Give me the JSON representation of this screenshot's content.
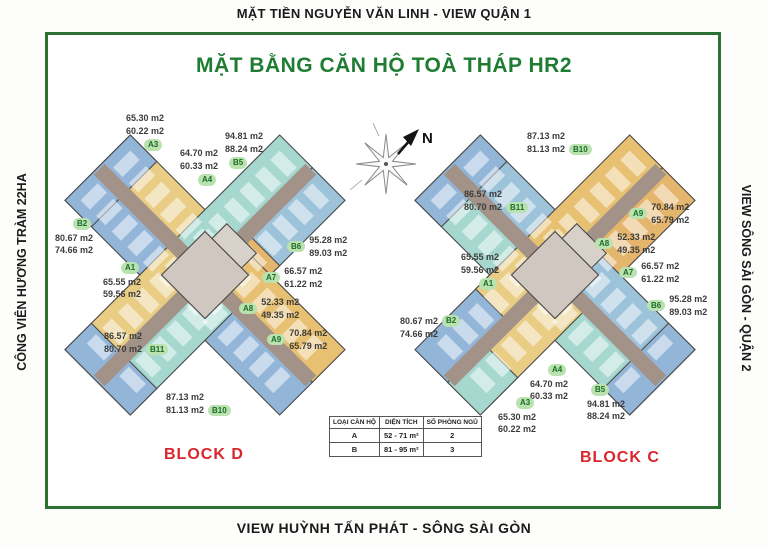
{
  "frame": {
    "top_label": "MẶT TIỀN NGUYỄN VĂN LINH - VIEW QUẬN 1",
    "bottom_label": "VIEW HUỲNH TẤN PHÁT - SÔNG SÀI GÒN",
    "left_label": "CÔNG VIÊN HƯƠNG TRÀM 22HA",
    "right_label": "VIEW SÔNG SÀI GÒN - QUẬN 2"
  },
  "title": "MẶT BẰNG CĂN HỘ TOÀ THÁP HR2",
  "compass": {
    "north_label": "N"
  },
  "blocks": [
    {
      "name": "BLOCK D",
      "units": [
        {
          "id": "A3",
          "area_gross": "65.30 m2",
          "area_net": "60.22 m2"
        },
        {
          "id": "A4",
          "area_gross": "64.70 m2",
          "area_net": "60.33 m2"
        },
        {
          "id": "B5",
          "area_gross": "94.81 m2",
          "area_net": "88.24 m2"
        },
        {
          "id": "B2",
          "area_gross": "80.67 m2",
          "area_net": "74.66 m2"
        },
        {
          "id": "A1",
          "area_gross": "65.55 m2",
          "area_net": "59.56 m2"
        },
        {
          "id": "B11",
          "area_gross": "86.57 m2",
          "area_net": "80.70 m2"
        },
        {
          "id": "B10",
          "area_gross": "87.13 m2",
          "area_net": "81.13 m2"
        },
        {
          "id": "B6",
          "area_gross": "95.28 m2",
          "area_net": "89.03 m2"
        },
        {
          "id": "A7",
          "area_gross": "66.57 m2",
          "area_net": "61.22 m2"
        },
        {
          "id": "A8",
          "area_gross": "52.33 m2",
          "area_net": "49.35 m2"
        },
        {
          "id": "A9",
          "area_gross": "70.84 m2",
          "area_net": "65.79 m2"
        }
      ]
    },
    {
      "name": "BLOCK C",
      "units": [
        {
          "id": "B10",
          "area_gross": "87.13 m2",
          "area_net": "81.13 m2"
        },
        {
          "id": "B11",
          "area_gross": "86.57 m2",
          "area_net": "80.70 m2"
        },
        {
          "id": "A9",
          "area_gross": "70.84 m2",
          "area_net": "65.79 m2"
        },
        {
          "id": "A8",
          "area_gross": "52.33 m2",
          "area_net": "49.35 m2"
        },
        {
          "id": "A7",
          "area_gross": "66.57 m2",
          "area_net": "61.22 m2"
        },
        {
          "id": "B6",
          "area_gross": "95.28 m2",
          "area_net": "89.03 m2"
        },
        {
          "id": "A1",
          "area_gross": "65.55 m2",
          "area_net": "59.56 m2"
        },
        {
          "id": "B2",
          "area_gross": "80.67 m2",
          "area_net": "74.66 m2"
        },
        {
          "id": "A4",
          "area_gross": "64.70 m2",
          "area_net": "60.33 m2"
        },
        {
          "id": "A3",
          "area_gross": "65.30 m2",
          "area_net": "60.22 m2"
        },
        {
          "id": "B5",
          "area_gross": "94.81 m2",
          "area_net": "88.24 m2"
        }
      ]
    }
  ],
  "legend_table": {
    "headers": [
      "LOẠI CĂN HỘ",
      "DIỆN TÍCH",
      "SỐ PHÒNG NGỦ"
    ],
    "rows": [
      {
        "type": "A",
        "area": "52 - 71 m²",
        "bedrooms": "2"
      },
      {
        "type": "B",
        "area": "81 - 95 m²",
        "bedrooms": "3"
      }
    ]
  },
  "colors": {
    "frame_green": "#2d7033",
    "title_green": "#1f7d33",
    "block_red": "#d9262c",
    "badge_bg": "#b9e2ae",
    "badge_text": "#1e6b2d",
    "plan_yellow": "#e9cd85",
    "plan_orange": "#e4b56d",
    "plan_teal": "#a6d8cf",
    "plan_blue": "#93b6d8",
    "plan_corridor": "#a29287"
  }
}
